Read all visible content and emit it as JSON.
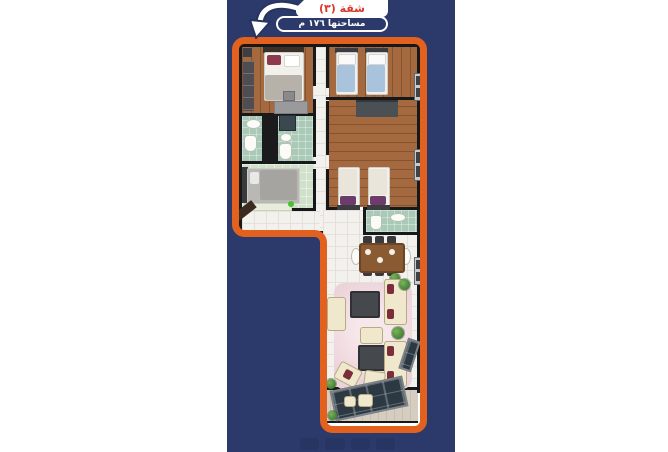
{
  "banner": {
    "apartment_label": "شقة (٣)",
    "area_label": "مساحتها ١٧٦ م"
  },
  "colors": {
    "page_bg": "#ffffff",
    "panel_blue": "#2c3a6b",
    "border_orange": "#e2611f",
    "banner_red": "#d93a2b",
    "wall_black": "#17181a",
    "wood_floor": "#a4693e",
    "bath_tile": "#a9cab6",
    "pale_floor": "#cfe0cb",
    "tile_floor": "#f3f1ed",
    "rug_pink": "#ecd3da",
    "sofa_cream": "#efe8cd",
    "balcony_floor": "#d6cdc1",
    "glass_dark": "#2c3942"
  },
  "floor_plan": {
    "shape": "L-shaped apartment, top-down 3D render",
    "rooms": [
      "master-bedroom",
      "bedroom-2",
      "bedroom-3",
      "bedroom-4",
      "bathroom-1",
      "bathroom-2",
      "wc",
      "entry-hall",
      "corridor",
      "dining-area",
      "kitchen-unit",
      "living-room",
      "balcony"
    ],
    "windows_right_wall": 3
  }
}
